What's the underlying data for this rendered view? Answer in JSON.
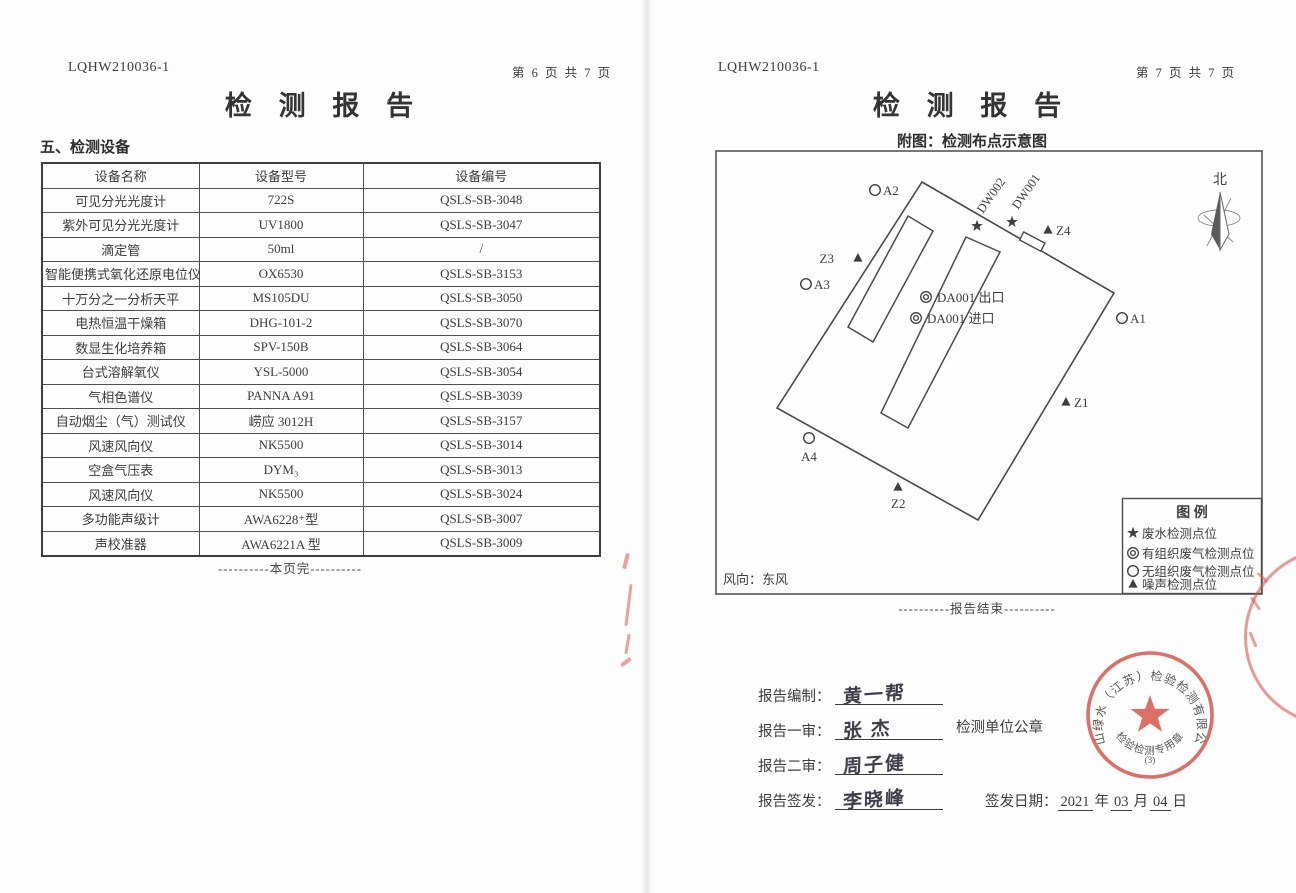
{
  "page_left": {
    "report_no": "LQHW210036-1",
    "page_no": "第 6 页 共 7 页",
    "title": "检 测 报 告",
    "section_title": "五、检测设备",
    "table": {
      "headers": [
        "设备名称",
        "设备型号",
        "设备编号"
      ],
      "rows": [
        [
          "可见分光光度计",
          "722S",
          "QSLS-SB-3048"
        ],
        [
          "紫外可见分光光度计",
          "UV1800",
          "QSLS-SB-3047"
        ],
        [
          "滴定管",
          "50ml",
          "/"
        ],
        [
          "智能便携式氧化还原电位仪",
          "OX6530",
          "QSLS-SB-3153"
        ],
        [
          "十万分之一分析天平",
          "MS105DU",
          "QSLS-SB-3050"
        ],
        [
          "电热恒温干燥箱",
          "DHG-101-2",
          "QSLS-SB-3070"
        ],
        [
          "数显生化培养箱",
          "SPV-150B",
          "QSLS-SB-3064"
        ],
        [
          "台式溶解氧仪",
          "YSL-5000",
          "QSLS-SB-3054"
        ],
        [
          "气相色谱仪",
          "PANNA A91",
          "QSLS-SB-3039"
        ],
        [
          "自动烟尘（气）测试仪",
          "崂应 3012H",
          "QSLS-SB-3157"
        ],
        [
          "风速风向仪",
          "NK5500",
          "QSLS-SB-3014"
        ],
        [
          "空盒气压表",
          "DYM₃",
          "QSLS-SB-3013"
        ],
        [
          "风速风向仪",
          "NK5500",
          "QSLS-SB-3024"
        ],
        [
          "多功能声级计",
          "AWA6228⁺型",
          "QSLS-SB-3007"
        ],
        [
          "声校准器",
          "AWA6221A 型",
          "QSLS-SB-3009"
        ]
      ]
    },
    "footer": "----------本页完----------"
  },
  "page_right": {
    "report_no": "LQHW210036-1",
    "page_no": "第 7 页 共 7 页",
    "title": "检 测 报 告",
    "subtitle": "附图：检测布点示意图",
    "diagram": {
      "north_label": "北",
      "wind_label": "风向：东风",
      "points": {
        "a1": "A1",
        "a2": "A2",
        "a3": "A3",
        "a4": "A4",
        "z1": "Z1",
        "z2": "Z2",
        "z3": "Z3",
        "z4": "Z4",
        "dw001": "DW001",
        "dw002": "DW002",
        "da001_out": "DA001 出口",
        "da001_in": "DA001 进口"
      },
      "legend": {
        "title": "图  例",
        "items": [
          {
            "symbol": "star",
            "label": "废水检测点位"
          },
          {
            "symbol": "bullseye",
            "label": "有组织废气检测点位"
          },
          {
            "symbol": "circle",
            "label": "无组织废气检测点位"
          },
          {
            "symbol": "triangle",
            "label": "噪声检测点位"
          }
        ]
      }
    },
    "footer": "----------报告结束----------",
    "signatures": [
      {
        "label": "报告编制：",
        "name": "黄一帮"
      },
      {
        "label": "报告一审：",
        "name": "张 杰"
      },
      {
        "label": "报告二审：",
        "name": "周子健"
      },
      {
        "label": "报告签发：",
        "name": "李晓峰"
      }
    ],
    "seal_caption": "检测单位公章",
    "issue_date": {
      "label": "签发日期：",
      "year": "2021",
      "y_unit": "年",
      "month": "03",
      "m_unit": "月",
      "day": "04",
      "d_unit": "日"
    },
    "seal": {
      "company": "青山绿水（江苏）检验检测有限公司",
      "type": "检验检测专用章",
      "number": "(3)"
    }
  },
  "colors": {
    "seal_red": "#d85c52",
    "ink": "#3c3c3c",
    "line": "#4a4a4a"
  }
}
